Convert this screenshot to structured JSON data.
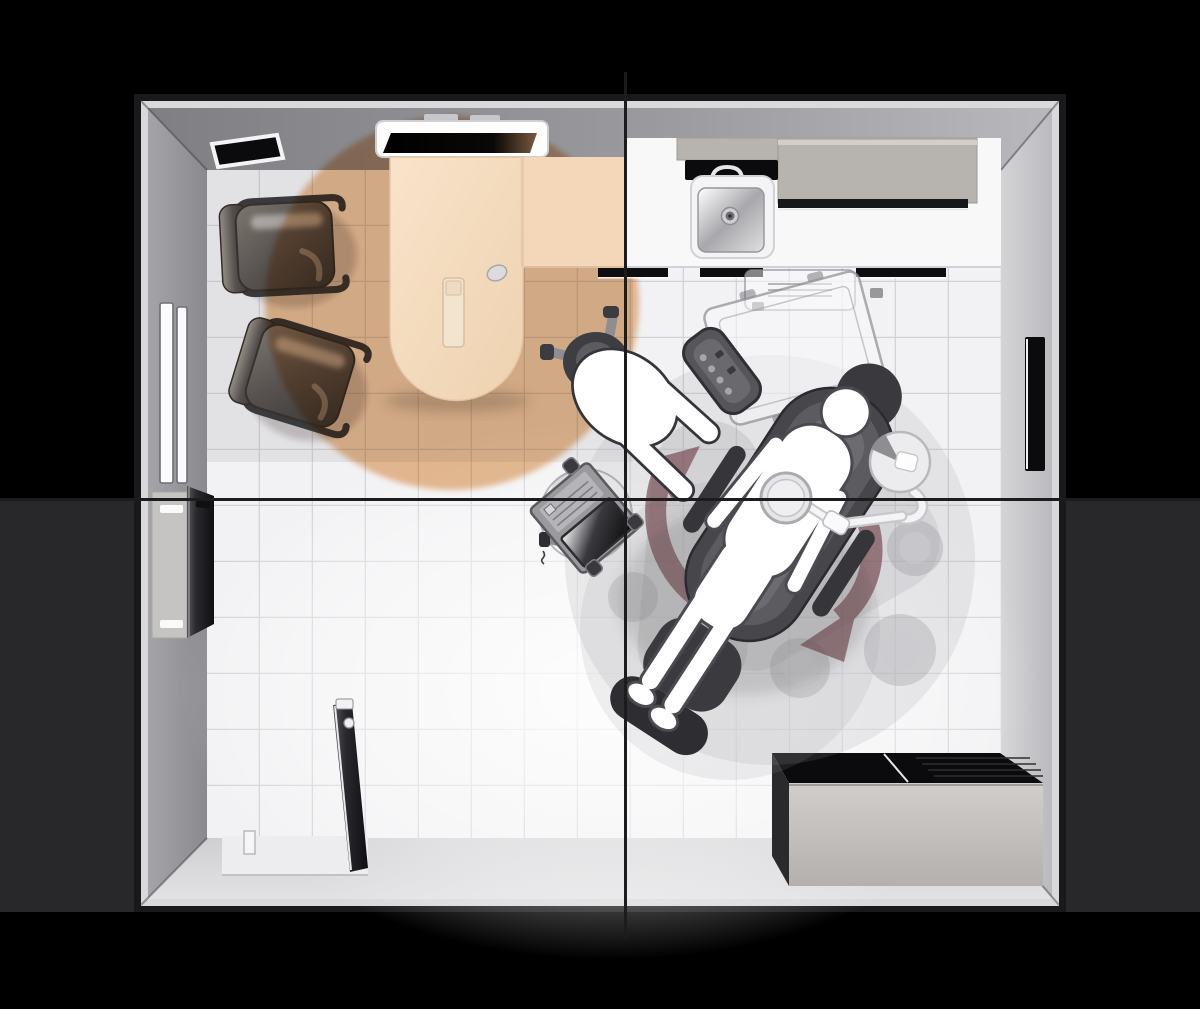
{
  "scene": {
    "kind": "top-view floor plan illustration",
    "subject": "dental treatment room with consultation area"
  },
  "colors": {
    "backdrop": "#000000",
    "band": "#28282a",
    "crosshair": "#1c1c1e",
    "wall_edge": "#d9d9db",
    "floor": "#f2f2f4",
    "tile_line": "#d3d3d7",
    "light_pool": "#ecbf95",
    "desk": "#f6ddc1",
    "desk_wing": "#f3d7b8",
    "counter": "#f8f8f9",
    "cabinet": "#b7b3af",
    "detail_black": "#0b0b0d",
    "silhouette": "#ffffff",
    "outline": "#3c3c41",
    "arrow": "#6b3c44",
    "ghost": "#9a9aa0",
    "dental_chair": "#47474b",
    "box_front": "#c6c2bf",
    "light_bar": "#fbfbfd",
    "door": "#2e2e32"
  },
  "elements": {
    "room": "treatment-room-floor-plan",
    "crosshair_v": "vertical-center-guide",
    "crosshair_h": "horizontal-center-guide",
    "light_pool": "warm-light-pool",
    "desk": "consultation-desk",
    "visitor_chair_1": "visitor-chair-upper",
    "visitor_chair_2": "visitor-chair-lower",
    "monitor_shelf": "wall-monitor-shelf",
    "wall_vent": "wall-vent-panel",
    "sink": "hygiene-sink",
    "upper_cabinets": "upper-cabinet-row",
    "countertop": "hygiene-countertop",
    "dental_chair": "dental-chair-with-patient",
    "patient": "patient-silhouette",
    "dentist": "dentist-silhouette",
    "dentist_stool": "dentist-stool",
    "operating_light": "operating-light",
    "assistant_unit": "chairside-delivery-unit",
    "control_pad": "chair-control-pad",
    "monitor_cart": "mobile-monitor-cart",
    "rotation_arrows": "chair-rotation-arrows",
    "ghosts": "ghost-equipment-positions",
    "wall_light": "left-wall-light",
    "window_slot": "right-wall-window-slot",
    "tall_cabinet": "left-storage-cabinet",
    "low_cabinet": "bottom-storage-cabinet",
    "door": "entry-door"
  }
}
